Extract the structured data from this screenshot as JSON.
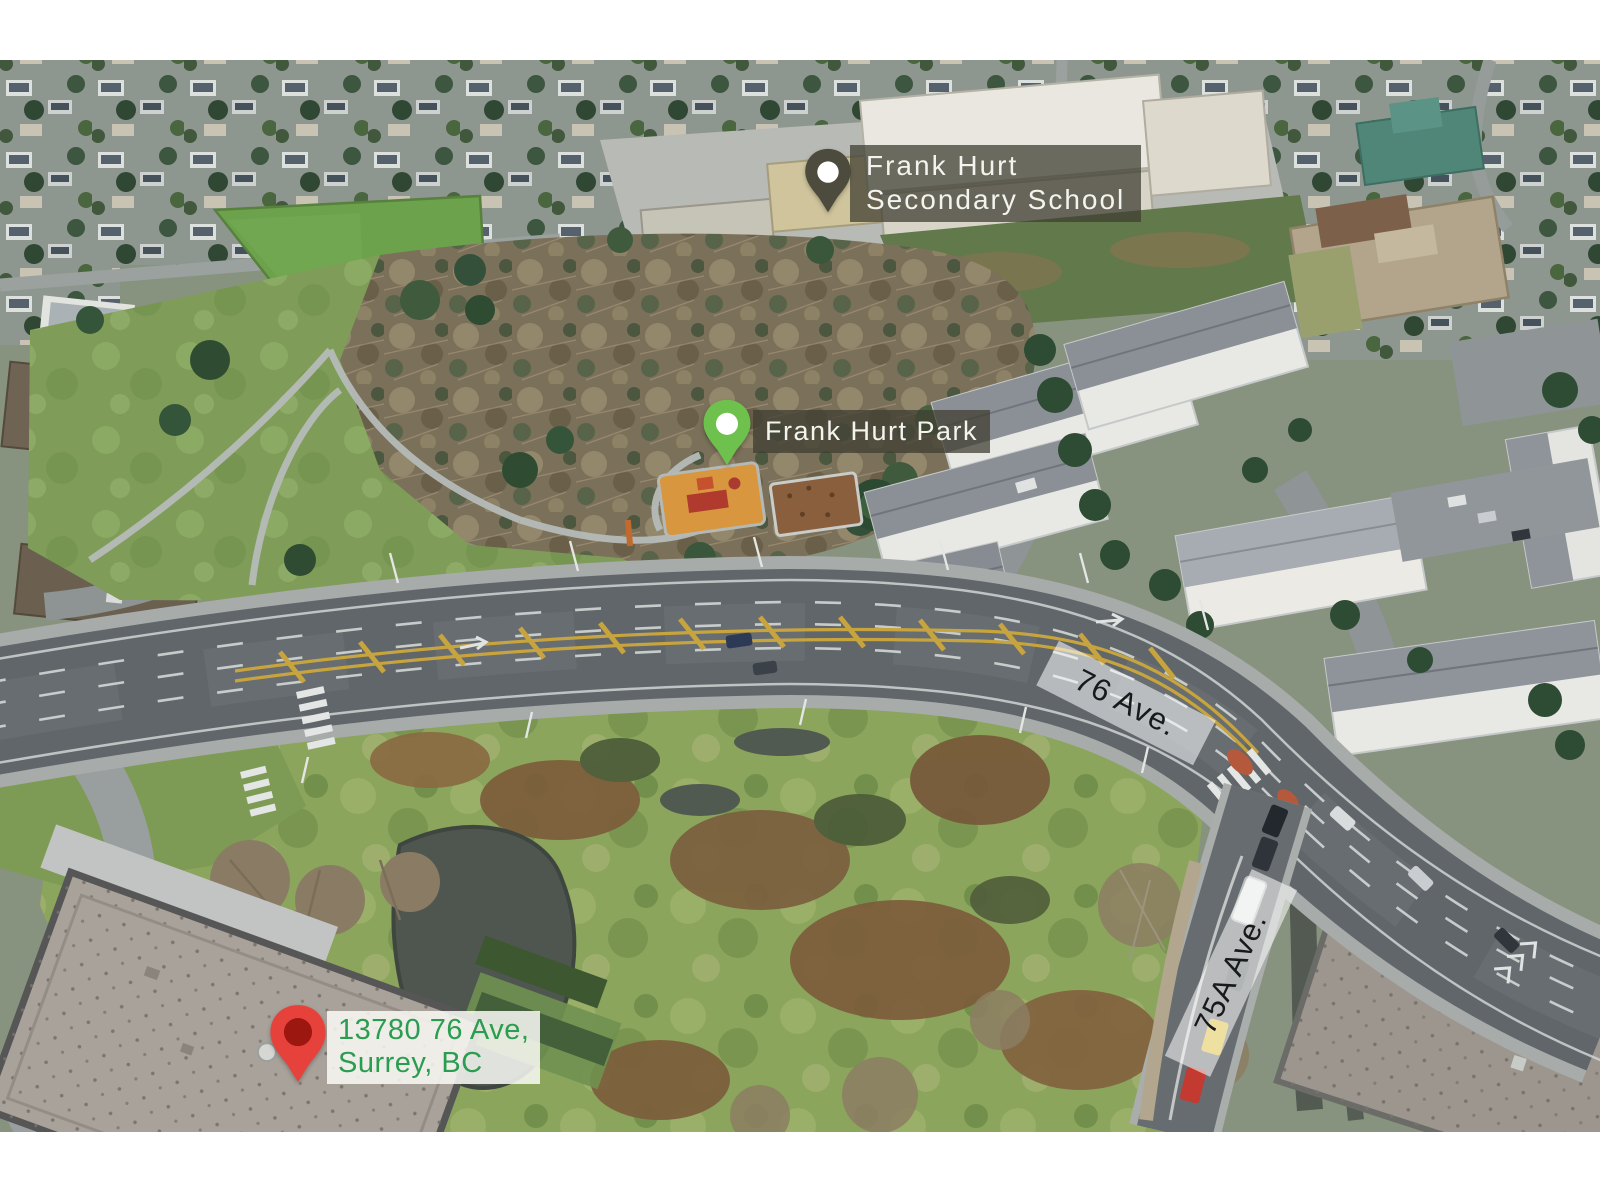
{
  "annotations": {
    "school": {
      "label_line1": "Frank Hurt",
      "label_line2": "Secondary School"
    },
    "park": {
      "label": "Frank Hurt Park"
    },
    "property": {
      "label_line1": "13780 76 Ave,",
      "label_line2": "Surrey, BC"
    },
    "streets": [
      {
        "name": "76 Ave."
      },
      {
        "name": "75A Ave."
      }
    ]
  },
  "colors": {
    "pin_school": "#4d4b3d",
    "pin_park": "#6fc14e",
    "pin_property": "#e6413a",
    "pin_property_dot": "#9c1710",
    "pin_dot_white": "#ffffff",
    "label_dark_bg": "rgba(64,62,50,0.74)",
    "label_dark_text": "#f4f4ef",
    "address_bg": "rgba(250,250,246,0.85)",
    "address_text": "#2a9d50",
    "street_band_bg": "rgba(255,255,255,0.55)",
    "street_text": "#17191b"
  }
}
